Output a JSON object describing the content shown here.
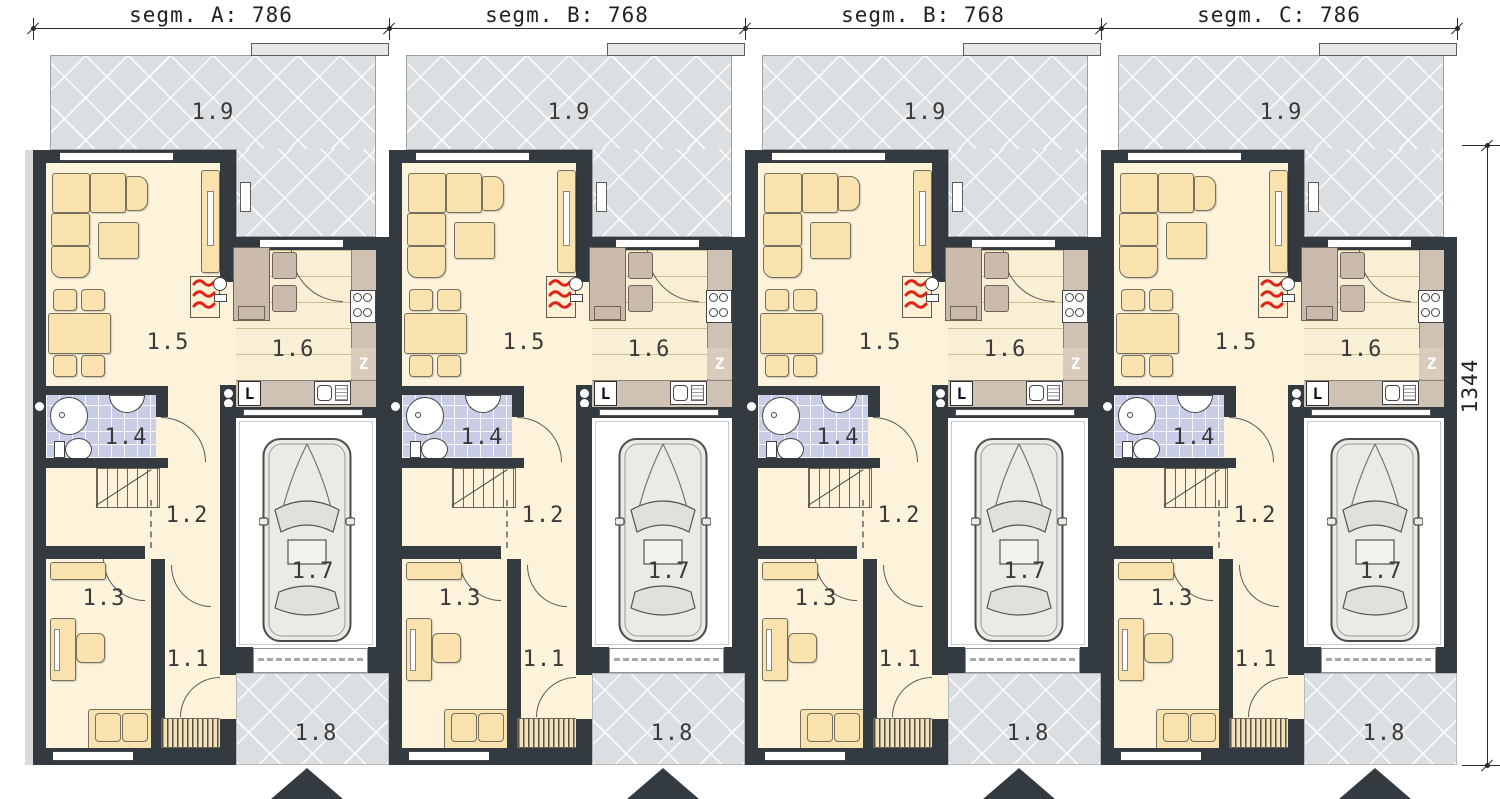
{
  "dimensions": {
    "top": [
      {
        "segment": "A",
        "label": "segm. A: 786",
        "value": 786
      },
      {
        "segment": "B",
        "label": "segm. B: 768",
        "value": 768
      },
      {
        "segment": "B",
        "label": "segm. B: 768",
        "value": 768
      },
      {
        "segment": "C",
        "label": "segm. C: 786",
        "value": 786
      }
    ],
    "right": {
      "label": "1344",
      "value": 1344
    }
  },
  "room_labels": {
    "entry": "1.1",
    "hall": "1.2",
    "office": "1.3",
    "bathroom": "1.4",
    "living_room": "1.5",
    "kitchen": "1.6",
    "garage": "1.7",
    "driveway": "1.8",
    "terrace": "1.9"
  },
  "appliances": {
    "fridge": "L",
    "dishwasher": "Z"
  },
  "colors": {
    "wall": "#333b41",
    "floor": "#fcf3da",
    "furniture": "#f9e2ae",
    "kitchen_counter": "#cfc1b3",
    "kitchen_table": "#cbbbad",
    "bathroom_floor": "#c9cde5",
    "paving": "#dcdfe1",
    "garage_floor": "#ffffff",
    "fireplace_flame": "#e02318",
    "dimension_line": "#2c2c2c"
  }
}
